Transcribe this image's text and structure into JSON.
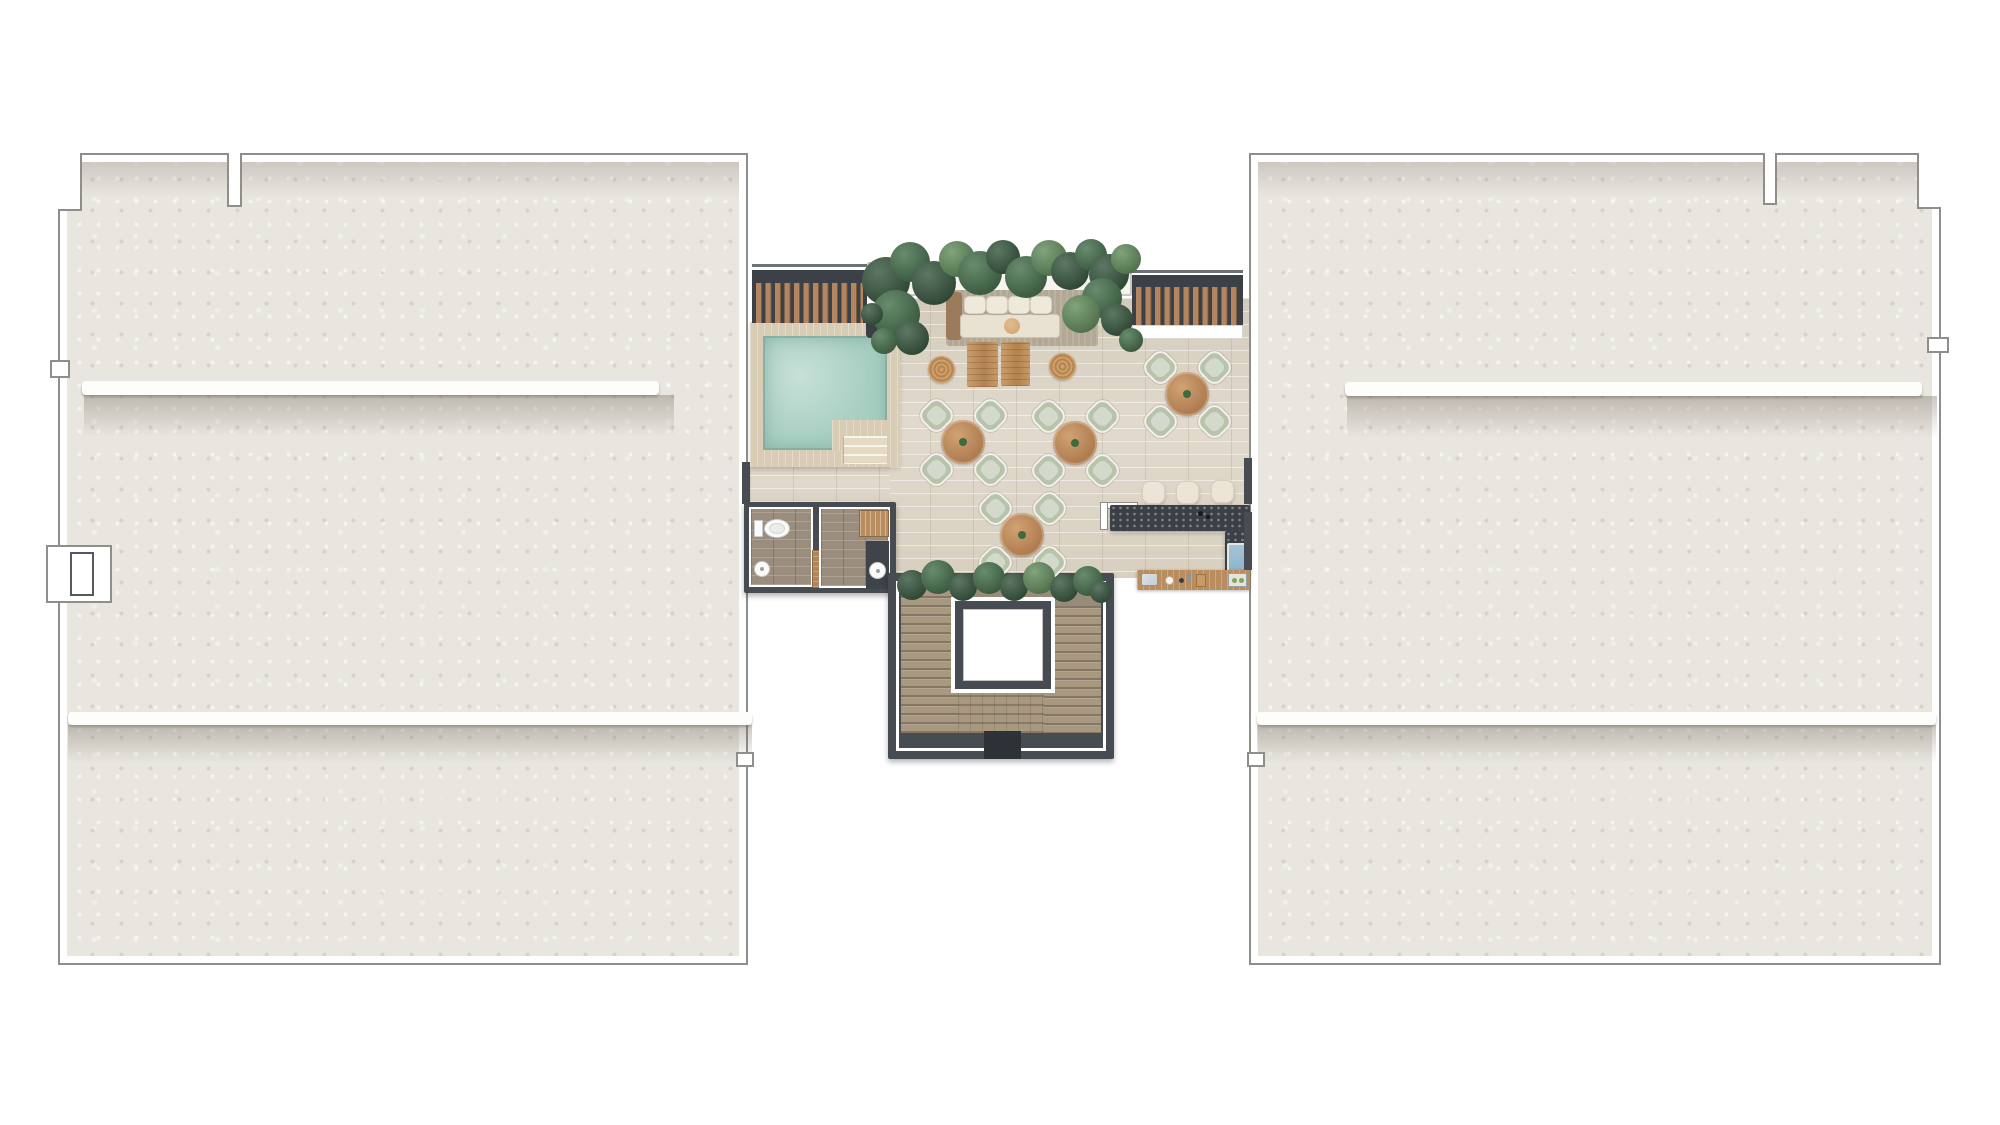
{
  "scene": {
    "kind": "architectural-floor-plan",
    "view": "top-down rooftop terrace level between two roof slabs",
    "visible_text": ""
  },
  "palette": {
    "bg": "#ffffff",
    "roof": "#e9e6e0",
    "outline": "#8e8e8b",
    "band": "#fdfdfc",
    "wallDark": "#474c52",
    "pergolaDark": "#3c4147",
    "pergolaWood": "#b3865f",
    "deck": "#d9ccb5",
    "pool": "#a8cfc2",
    "tile": "#ded6c7",
    "plantDark": "#2e5137",
    "plantMid": "#3e6b45",
    "plantLight": "#5d8a57",
    "rug": "#b3a795",
    "sofaWood": "#9b7b5a",
    "cushion": "#efe9db",
    "cushionTan": "#cfa36b",
    "tableWood": "#c6915f",
    "tableWoodDark": "#a9764a",
    "chair": "#b8c3ac",
    "chairLine": "#f4f1ea",
    "rattan": "#c9996a",
    "barTop": "#3b4046",
    "stool": "#ece5d7",
    "fridge": "#8fb4cd",
    "counterWood": "#b98d5e",
    "steel": "#c6ccd2",
    "stairWood": "#a89880",
    "stairFloor": "#988c79",
    "bathTile": "#9a8d7e",
    "doorWood": "#b28457",
    "porcelain": "#fbfbfa"
  },
  "furniture": {
    "dining_sets": {
      "count": 4,
      "chairs_per_table": 4,
      "positions": [
        {
          "x": 963,
          "y": 442
        },
        {
          "x": 1075,
          "y": 443
        },
        {
          "x": 1022,
          "y": 535
        },
        {
          "x": 1187,
          "y": 394
        }
      ]
    },
    "bar_stools": {
      "count": 3,
      "positions": [
        {
          "x": 1153,
          "y": 492
        },
        {
          "x": 1187,
          "y": 492
        },
        {
          "x": 1222,
          "y": 491
        }
      ]
    },
    "rattan_side_tables": {
      "count": 2,
      "positions": [
        {
          "x": 941,
          "y": 369
        },
        {
          "x": 1062,
          "y": 366
        }
      ]
    },
    "sofa_cushions": {
      "count": 4,
      "y": 296,
      "x_positions": [
        964,
        986,
        1008,
        1030
      ]
    },
    "wood_dining_tables": 2,
    "pool_steps": 3,
    "toilet": 1,
    "sinks": 2,
    "fridge": 1,
    "elevator": 1
  },
  "decor": {
    "foliage": [
      {
        "x": 886,
        "y": 281,
        "r": 24,
        "c": "plantDark"
      },
      {
        "x": 910,
        "y": 262,
        "r": 20,
        "c": "plantMid"
      },
      {
        "x": 934,
        "y": 283,
        "r": 22,
        "c": "plantDark"
      },
      {
        "x": 957,
        "y": 259,
        "r": 18,
        "c": "plantLight"
      },
      {
        "x": 980,
        "y": 273,
        "r": 22,
        "c": "plantMid"
      },
      {
        "x": 1003,
        "y": 257,
        "r": 17,
        "c": "plantDark"
      },
      {
        "x": 1026,
        "y": 277,
        "r": 21,
        "c": "plantMid"
      },
      {
        "x": 1049,
        "y": 258,
        "r": 18,
        "c": "plantLight"
      },
      {
        "x": 1070,
        "y": 271,
        "r": 19,
        "c": "plantDark"
      },
      {
        "x": 1091,
        "y": 255,
        "r": 16,
        "c": "plantMid"
      },
      {
        "x": 1109,
        "y": 274,
        "r": 20,
        "c": "plantDark"
      },
      {
        "x": 1126,
        "y": 259,
        "r": 15,
        "c": "plantLight"
      },
      {
        "x": 896,
        "y": 314,
        "r": 24,
        "c": "plantMid"
      },
      {
        "x": 912,
        "y": 338,
        "r": 17,
        "c": "plantDark"
      },
      {
        "x": 884,
        "y": 341,
        "r": 13,
        "c": "plantMid"
      },
      {
        "x": 872,
        "y": 314,
        "r": 11,
        "c": "plantDark"
      },
      {
        "x": 1102,
        "y": 298,
        "r": 20,
        "c": "plantMid"
      },
      {
        "x": 1117,
        "y": 320,
        "r": 16,
        "c": "plantDark"
      },
      {
        "x": 1131,
        "y": 340,
        "r": 12,
        "c": "plantMid"
      },
      {
        "x": 1081,
        "y": 314,
        "r": 19,
        "c": "plantLight"
      },
      {
        "x": 912,
        "y": 585,
        "r": 15,
        "c": "plantDark"
      },
      {
        "x": 938,
        "y": 577,
        "r": 17,
        "c": "plantMid"
      },
      {
        "x": 963,
        "y": 587,
        "r": 14,
        "c": "plantDark"
      },
      {
        "x": 989,
        "y": 578,
        "r": 16,
        "c": "plantMid"
      },
      {
        "x": 1014,
        "y": 587,
        "r": 14,
        "c": "plantDark"
      },
      {
        "x": 1039,
        "y": 578,
        "r": 16,
        "c": "plantLight"
      },
      {
        "x": 1064,
        "y": 588,
        "r": 14,
        "c": "plantDark"
      },
      {
        "x": 1088,
        "y": 581,
        "r": 15,
        "c": "plantMid"
      },
      {
        "x": 1101,
        "y": 592,
        "r": 11,
        "c": "plantDark"
      }
    ]
  }
}
